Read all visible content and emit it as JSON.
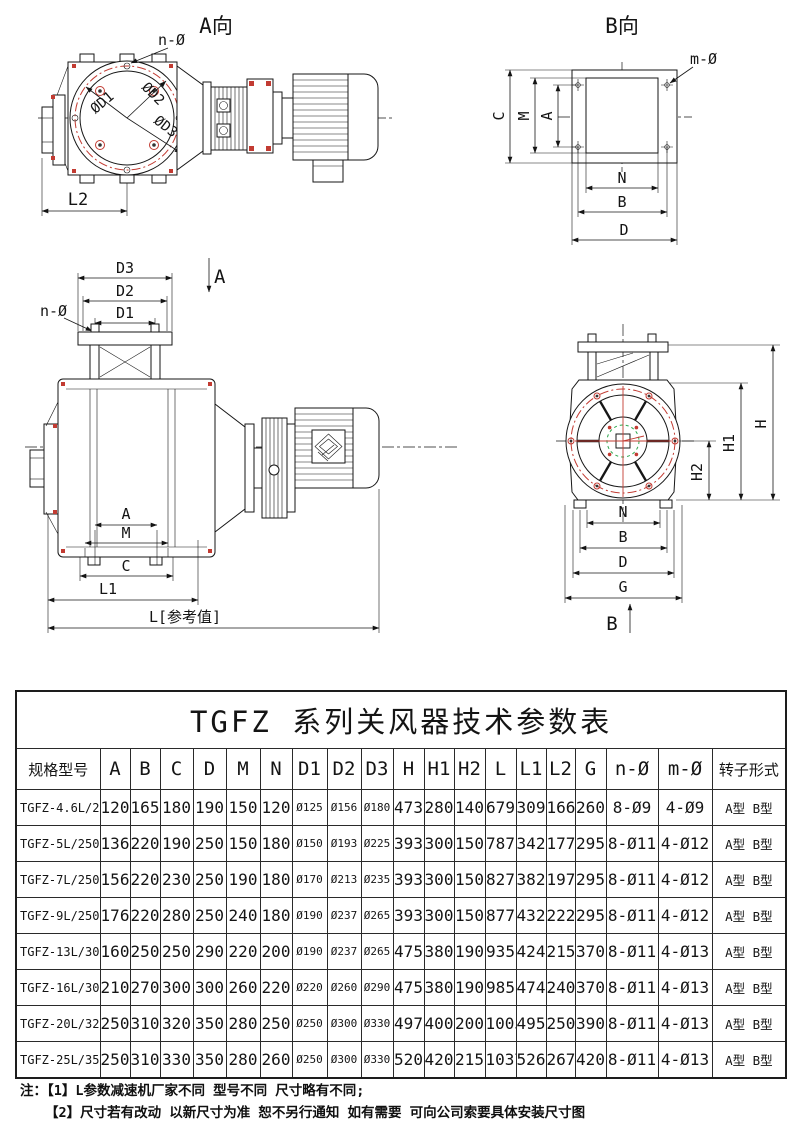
{
  "views": {
    "view_a": {
      "title": "A向",
      "n_label": "n-Ø",
      "d1": "ØD1",
      "d2": "ØD2",
      "d3": "ØD3",
      "l2": "L2"
    },
    "view_b": {
      "title": "B向",
      "m_label": "m-Ø",
      "dim_c": "C",
      "dim_m": "M",
      "dim_a": "A",
      "dim_n": "N",
      "dim_b": "B",
      "dim_d": "D"
    },
    "front": {
      "dim_d3": "D3",
      "dim_d2": "D2",
      "dim_d1": "D1",
      "n_label": "n-Ø",
      "section_a": "A",
      "dim_a": "A",
      "dim_m": "M",
      "dim_c": "C",
      "dim_l1": "L1",
      "dim_l": "L[参考值]"
    },
    "end": {
      "dim_h": "H",
      "dim_h1": "H1",
      "dim_h2": "H2",
      "dim_n": "N",
      "dim_b": "B",
      "dim_d": "D",
      "dim_g": "G",
      "section_b": "B"
    }
  },
  "table": {
    "title": "TGFZ 系列关风器技术参数表",
    "headers": [
      "规格型号",
      "A",
      "B",
      "C",
      "D",
      "M",
      "N",
      "D1",
      "D2",
      "D3",
      "H",
      "H1",
      "H2",
      "L",
      "L1",
      "L2",
      "G",
      "n-Ø",
      "m-Ø",
      "转子形式"
    ],
    "rows": [
      [
        "TGFZ-4.6L/210",
        "120",
        "165",
        "180",
        "190",
        "150",
        "120",
        "Ø125",
        "Ø156",
        "Ø180",
        "473",
        "280",
        "140",
        "679",
        "309",
        "166",
        "260",
        "8-Ø9",
        "4-Ø9",
        "A型 B型"
      ],
      [
        "TGFZ-5L/250",
        "136",
        "220",
        "190",
        "250",
        "150",
        "180",
        "Ø150",
        "Ø193",
        "Ø225",
        "393",
        "300",
        "150",
        "787",
        "342",
        "177",
        "295",
        "8-Ø11",
        "4-Ø12",
        "A型 B型"
      ],
      [
        "TGFZ-7L/250",
        "156",
        "220",
        "230",
        "250",
        "190",
        "180",
        "Ø170",
        "Ø213",
        "Ø235",
        "393",
        "300",
        "150",
        "827",
        "382",
        "197",
        "295",
        "8-Ø11",
        "4-Ø12",
        "A型 B型"
      ],
      [
        "TGFZ-9L/250",
        "176",
        "220",
        "280",
        "250",
        "240",
        "180",
        "Ø190",
        "Ø237",
        "Ø265",
        "393",
        "300",
        "150",
        "877",
        "432",
        "222",
        "295",
        "8-Ø11",
        "4-Ø12",
        "A型 B型"
      ],
      [
        "TGFZ-13L/300",
        "160",
        "250",
        "250",
        "290",
        "220",
        "200",
        "Ø190",
        "Ø237",
        "Ø265",
        "475",
        "380",
        "190",
        "935",
        "424",
        "215",
        "370",
        "8-Ø11",
        "4-Ø13",
        "A型 B型"
      ],
      [
        "TGFZ-16L/300",
        "210",
        "270",
        "300",
        "300",
        "260",
        "220",
        "Ø220",
        "Ø260",
        "Ø290",
        "475",
        "380",
        "190",
        "985",
        "474",
        "240",
        "370",
        "8-Ø11",
        "4-Ø13",
        "A型 B型"
      ],
      [
        "TGFZ-20L/320",
        "250",
        "310",
        "320",
        "350",
        "280",
        "250",
        "Ø250",
        "Ø300",
        "Ø330",
        "497",
        "400",
        "200",
        "1005",
        "495",
        "250",
        "390",
        "8-Ø11",
        "4-Ø13",
        "A型 B型"
      ],
      [
        "TGFZ-25L/350",
        "250",
        "310",
        "330",
        "350",
        "280",
        "260",
        "Ø250",
        "Ø300",
        "Ø330",
        "520",
        "420",
        "215",
        "1037",
        "526",
        "267",
        "420",
        "8-Ø11",
        "4-Ø13",
        "A型 B型"
      ]
    ]
  },
  "notes": {
    "line1": "注：【1】L参数减速机厂家不同 型号不同 尺寸略有不同;",
    "line2": "【2】尺寸若有改动 以新尺寸为准 恕不另行通知 如有需要 可向公司索要具体安装尺寸图"
  }
}
